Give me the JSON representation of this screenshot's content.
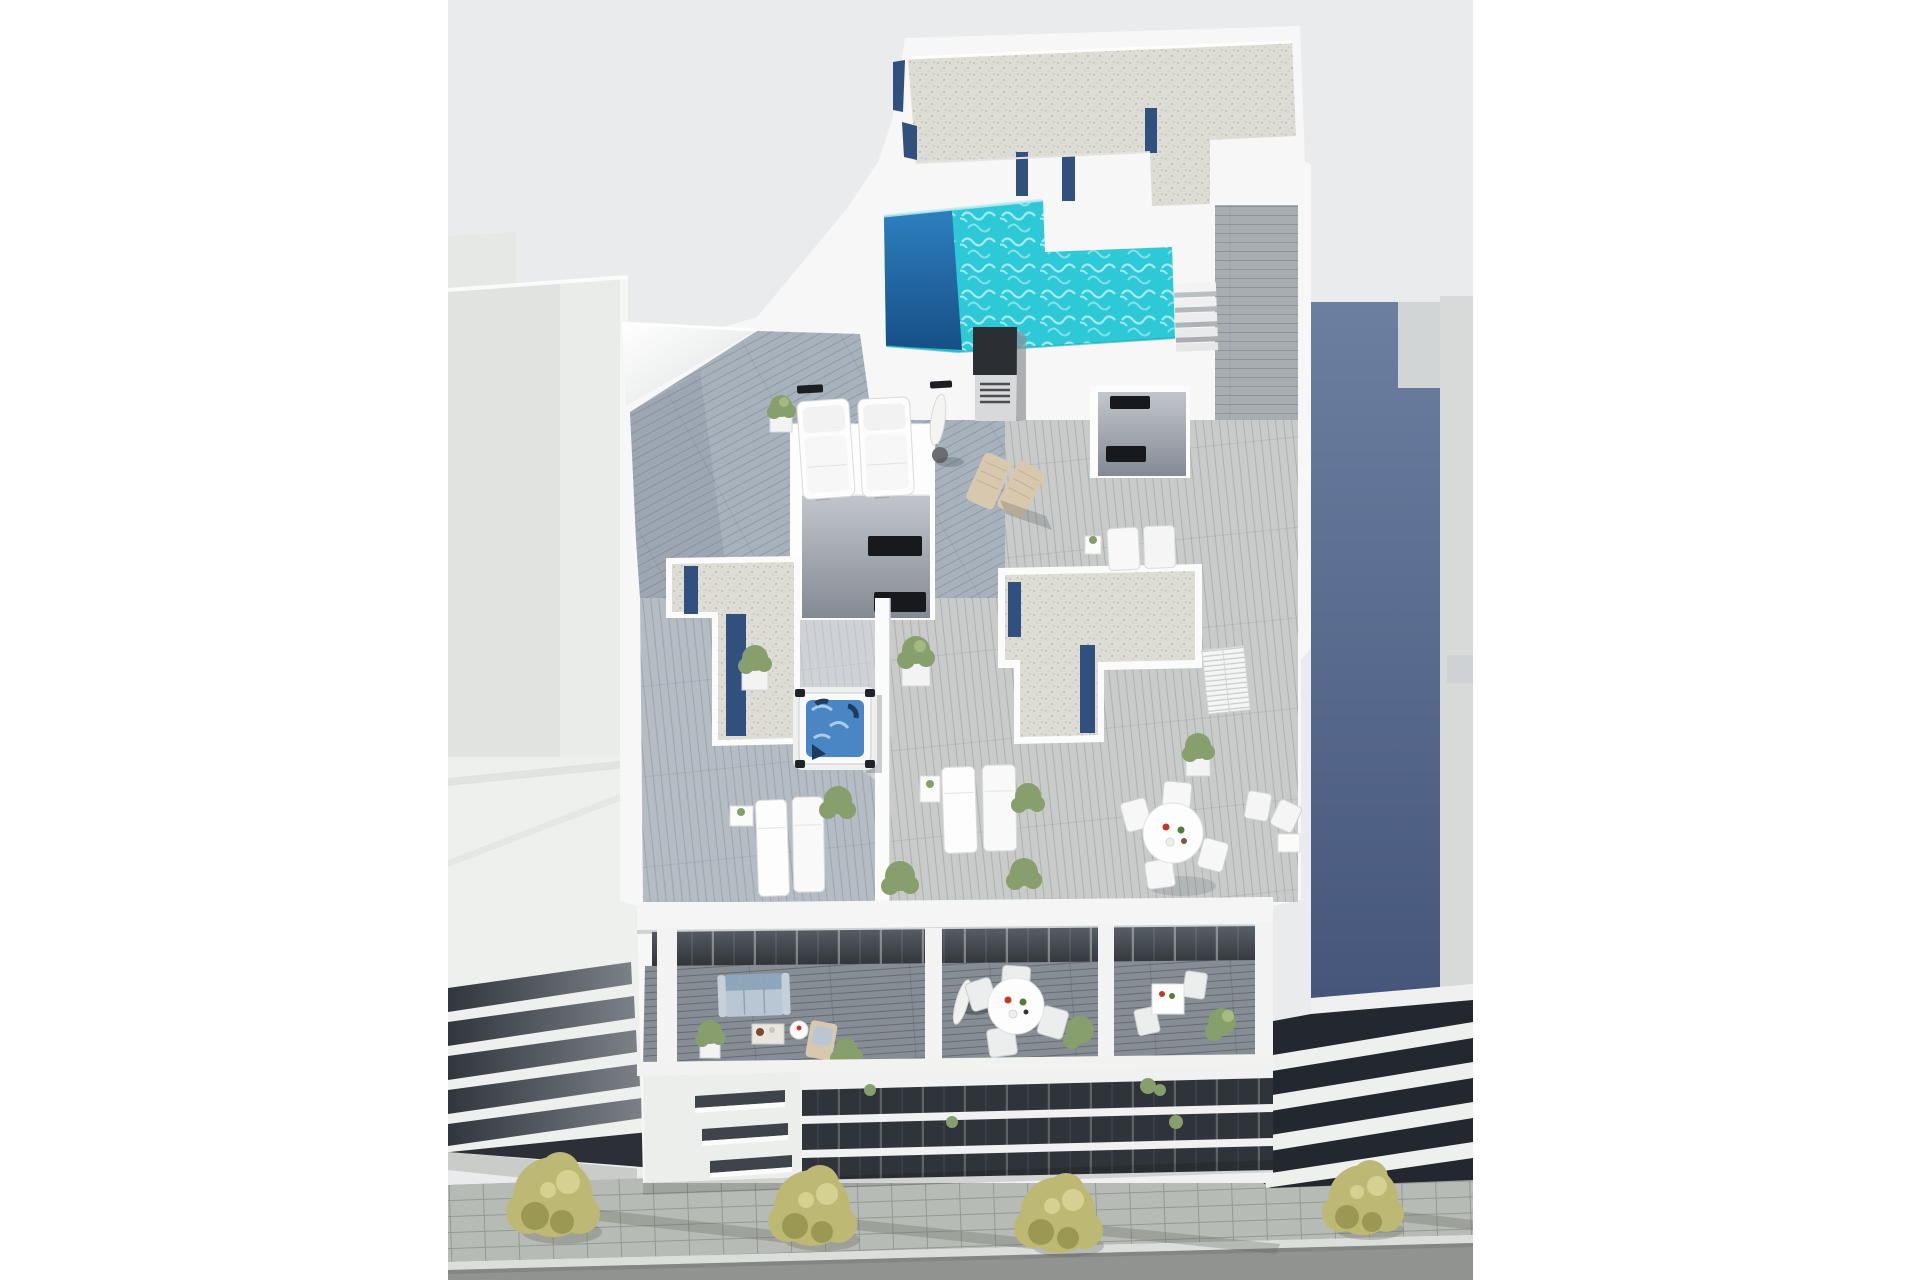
{
  "meta": {
    "title": "Aerial 3D architectural rendering of a modern white apartment building with rooftop pool terrace",
    "render_type": "architectural-3d-render",
    "view": "aerial-top-down",
    "text_content": "none"
  },
  "colors": {
    "page_bg": "#ffffff",
    "render_bg": "#eaebec",
    "building_white": "#f6f7f6",
    "wall_bright": "#fdfdfd",
    "gravel": "#dddcd5",
    "glass_navy": "#31507e",
    "pool_turquoise": "#2ec9d7",
    "pool_deep": "#1a67a7",
    "jacuzzi_water": "#4a86c3",
    "deck_upper": "#a8b2bd",
    "deck_left_terrace": "#b5bcc3",
    "deck_right_zone": "#c8cbc9",
    "deck_corridor": "#a8adb1",
    "deck_balcony": "#868d94",
    "interior_dark": "#35393f",
    "window_black": "#17191d",
    "neighbor_gray": "#e1e3e1",
    "neighbor_blue": "#566a8e",
    "neighbor_roof_strip": "#d8dad9",
    "dark_facade": "#23272e",
    "facade_white": "#f0f1f0",
    "tree_green": "#bdb975",
    "tree_shade": "#96934f",
    "plant_green": "#879e6d",
    "road": "#90938f",
    "sidewalk": "#b7bbb6",
    "curb": "#dcdedc",
    "wood_tan": "#d8c9ae",
    "sofa_back": "#8ea6bc",
    "sofa_seat": "#b9c7d5",
    "chimney_dark": "#2b2e33"
  },
  "scene": {
    "objects": [
      {
        "id": "rooftop-pool",
        "label": "L-shaped rooftop swimming pool with turquoise water and deep blue end"
      },
      {
        "id": "pool-stairs",
        "label": "white steps from pool deck down to terrace"
      },
      {
        "id": "gravel-roof-top",
        "label": "gravel covered upper roof with navy glass balustrade strips"
      },
      {
        "id": "gravel-skylight-left",
        "label": "left gravel roof section with recessed navy skylight strips"
      },
      {
        "id": "gravel-skylight-right",
        "label": "right gravel roof section with recessed navy skylight strips"
      },
      {
        "id": "chimney-vent",
        "label": "dark rooftop chimney vent box with grille"
      },
      {
        "id": "stair-bulkhead-left",
        "label": "white stair bulkhead with two dark slit windows"
      },
      {
        "id": "stair-bulkhead-right",
        "label": "white stair bulkhead with two dark slit windows"
      },
      {
        "id": "jacuzzi",
        "label": "square hot tub with blue water on wood deck"
      },
      {
        "id": "daybeds",
        "label": "two white tufted sun daybeds on upper terrace"
      },
      {
        "id": "parasol-closed-roof",
        "label": "closed white parasol with round base"
      },
      {
        "id": "wooden-deck-chairs",
        "label": "two tan wooden deck chairs"
      },
      {
        "id": "loungers-left-terrace",
        "label": "two white sun loungers with side table"
      },
      {
        "id": "loungers-right-terrace",
        "label": "two white sun loungers with side table"
      },
      {
        "id": "loungers-by-corridor",
        "label": "two small white loungers beside stair bulkhead"
      },
      {
        "id": "rooftop-dining-set",
        "label": "round white dining table with four chairs"
      },
      {
        "id": "louvered-doors",
        "label": "white louvered storage doors"
      },
      {
        "id": "balcony-sofa",
        "label": "light blue three-seat sofa with coffee table and plants"
      },
      {
        "id": "balcony-dining-set",
        "label": "round white balcony dining table with four chairs and closed parasol"
      },
      {
        "id": "balcony-bistro-set",
        "label": "small square table with chairs on right balcony"
      },
      {
        "id": "potted-plants",
        "label": "white cube planters with green shrubs"
      },
      {
        "id": "facade-vents",
        "label": "three slanted vent slits on left facade column"
      },
      {
        "id": "facade-window-bands",
        "label": "dark horizontal window bands between white slabs"
      },
      {
        "id": "left-neighbor",
        "label": "light gray neighboring building with striped balcony slabs"
      },
      {
        "id": "right-neighbor",
        "label": "neighboring building with blue-gray side wall and dark striped facade"
      },
      {
        "id": "street-trees",
        "label": "four yellow-green street trees casting shadows"
      },
      {
        "id": "sidewalk",
        "label": "paved sidewalk"
      },
      {
        "id": "road",
        "label": "asphalt road"
      }
    ]
  }
}
